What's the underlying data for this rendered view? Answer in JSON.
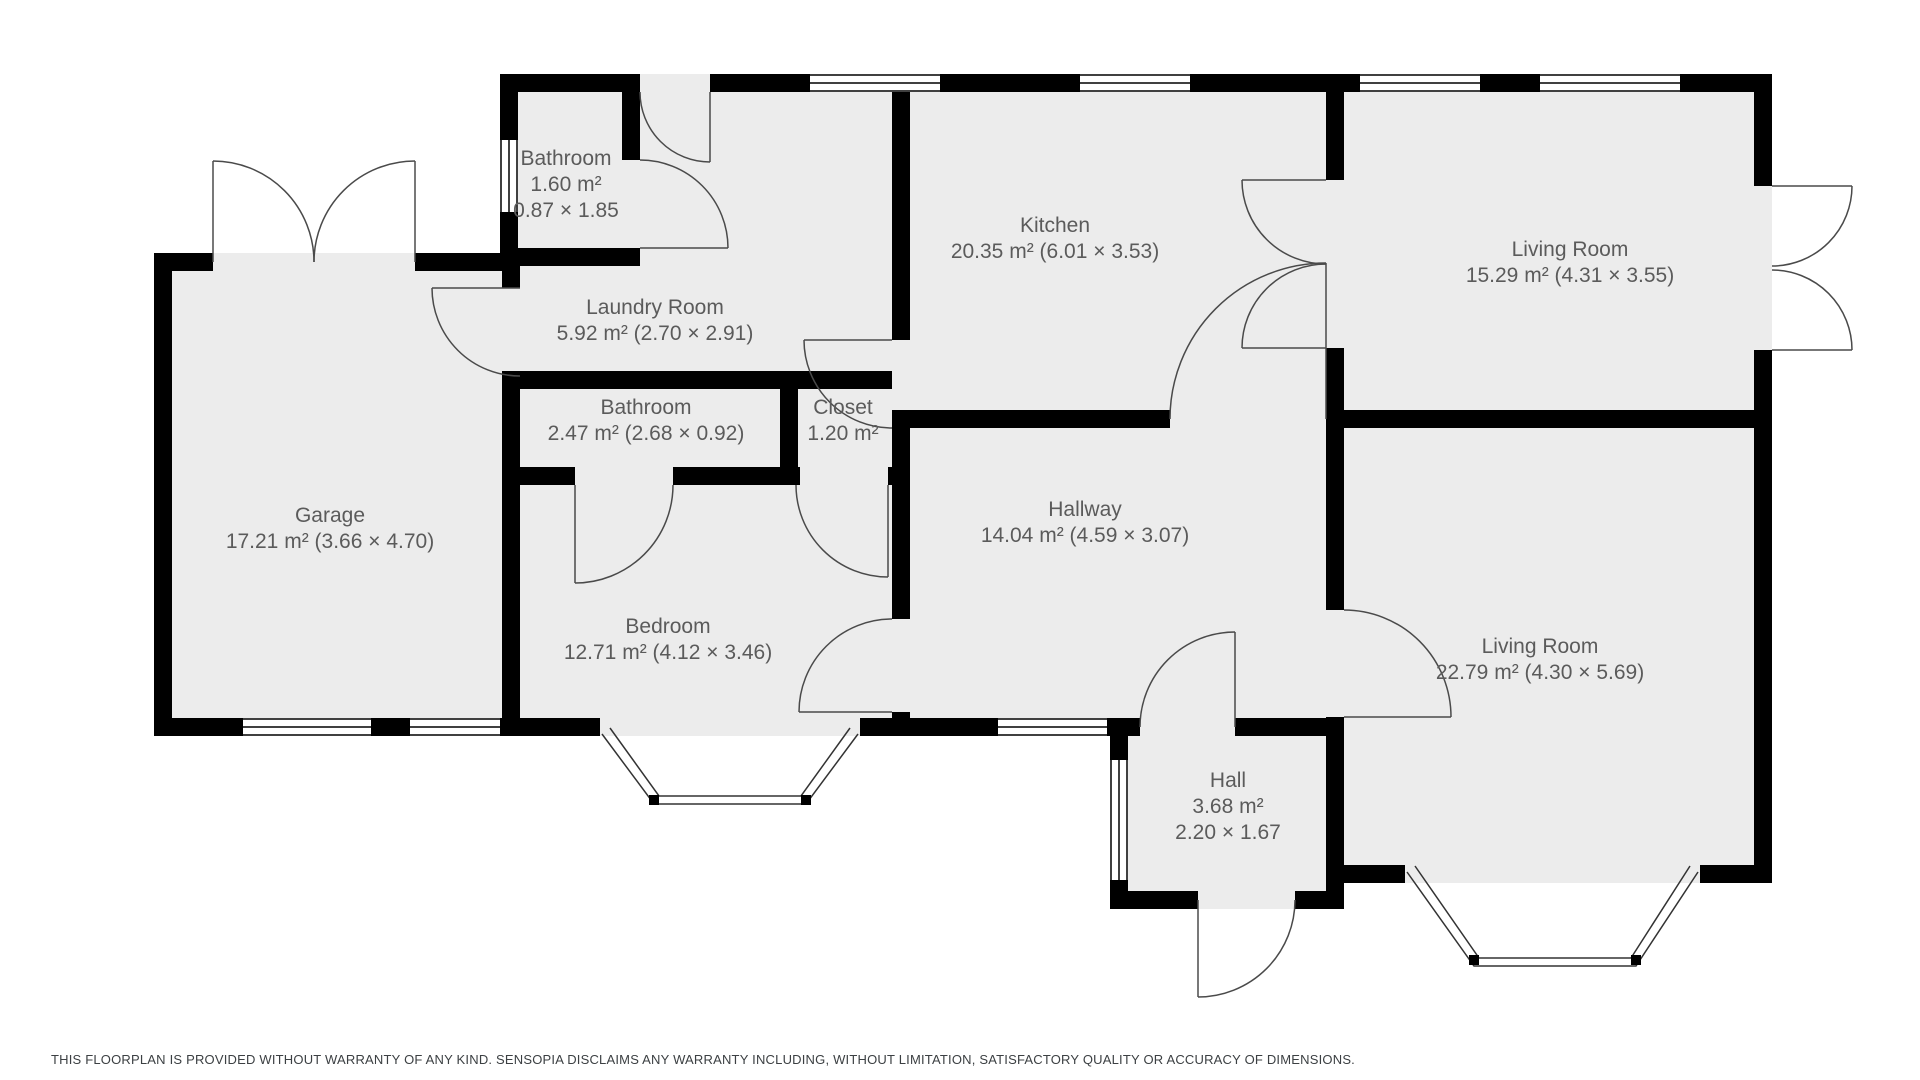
{
  "colors": {
    "wall": "#000000",
    "floor": "#ececec",
    "label_text": "#5b5b5b",
    "door_stroke": "#4a4a4a",
    "background": "#ffffff"
  },
  "rooms": [
    {
      "id": "bathroom-small",
      "name": "Bathroom",
      "line2": "1.60 m²",
      "line3": "0.87 × 1.85"
    },
    {
      "id": "laundry-room",
      "name": "Laundry Room",
      "line2": "5.92 m² (2.70 × 2.91)",
      "line3": ""
    },
    {
      "id": "kitchen",
      "name": "Kitchen",
      "line2": "20.35 m² (6.01 × 3.53)",
      "line3": ""
    },
    {
      "id": "living-room-top",
      "name": "Living Room",
      "line2": "15.29 m² (4.31 × 3.55)",
      "line3": ""
    },
    {
      "id": "bathroom-middle",
      "name": "Bathroom",
      "line2": "2.47 m² (2.68 × 0.92)",
      "line3": ""
    },
    {
      "id": "closet",
      "name": "Closet",
      "line2": "1.20 m²",
      "line3": ""
    },
    {
      "id": "garage",
      "name": "Garage",
      "line2": "17.21 m² (3.66 × 4.70)",
      "line3": ""
    },
    {
      "id": "bedroom",
      "name": "Bedroom",
      "line2": "12.71 m² (4.12 × 3.46)",
      "line3": ""
    },
    {
      "id": "hallway",
      "name": "Hallway",
      "line2": "14.04 m² (4.59 × 3.07)",
      "line3": ""
    },
    {
      "id": "living-room-bottom",
      "name": "Living Room",
      "line2": "22.79 m² (4.30 × 5.69)",
      "line3": ""
    },
    {
      "id": "hall",
      "name": "Hall",
      "line2": "3.68 m²",
      "line3": "2.20 × 1.67"
    }
  ],
  "footer": {
    "disclaimer": "THIS FLOORPLAN IS PROVIDED WITHOUT WARRANTY OF ANY KIND. SENSOPIA DISCLAIMS ANY WARRANTY INCLUDING, WITHOUT LIMITATION, SATISFACTORY QUALITY OR ACCURACY OF DIMENSIONS."
  }
}
